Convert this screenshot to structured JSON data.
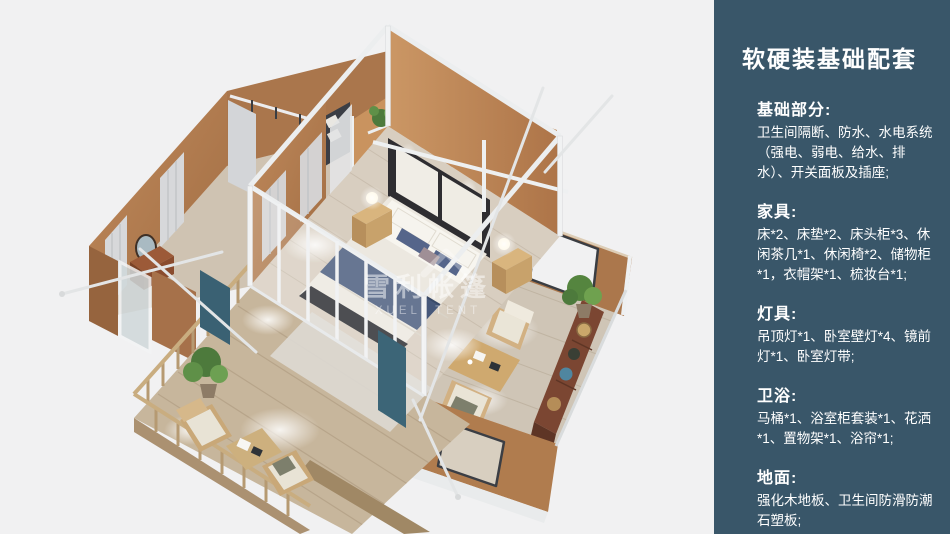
{
  "sidebar": {
    "background_color": "#395669",
    "text_color": "#ffffff",
    "title": "软硬装基础配套",
    "sections": [
      {
        "heading": "基础部分:",
        "body": "卫生间隔断、防水、水电系统（强电、弱电、给水、排水）、开关面板及插座;"
      },
      {
        "heading": "家具:",
        "body": "床*2、床垫*2、床头柜*3、休闲茶几*1、休闲椅*2、储物柜*1，衣帽架*1、梳妆台*1;"
      },
      {
        "heading": "灯具:",
        "body": "吊顶灯*1、卧室壁灯*4、镜前灯*1、卧室灯带;"
      },
      {
        "heading": "卫浴:",
        "body": "马桶*1、浴室柜套装*1、花洒*1、置物架*1、浴帘*1;"
      },
      {
        "heading": "地面:",
        "body": "强化木地板、卫生间防滑防潮石塑板;"
      }
    ]
  },
  "scene": {
    "description": "isometric 3D render of glamping tent house with central bedroom, side lounge wings, bathroom wing and wooden deck",
    "watermark": {
      "cn": "雪利帐篷",
      "en": "XUELI TENT"
    },
    "palette": {
      "background": "#f1f1f2",
      "wall_tan": "#b5815a",
      "wall_tan_lit": "#c7925f",
      "floor_wood": "#d8cec0",
      "deck_wood": "#c7b69c",
      "frame_white": "#eef0f1",
      "bed_navy": "#46587a",
      "curtain_teal": "#3a6173",
      "sofa_gray": "#50545c",
      "plant_green": "#55853f",
      "walnut": "#7b4632"
    }
  }
}
